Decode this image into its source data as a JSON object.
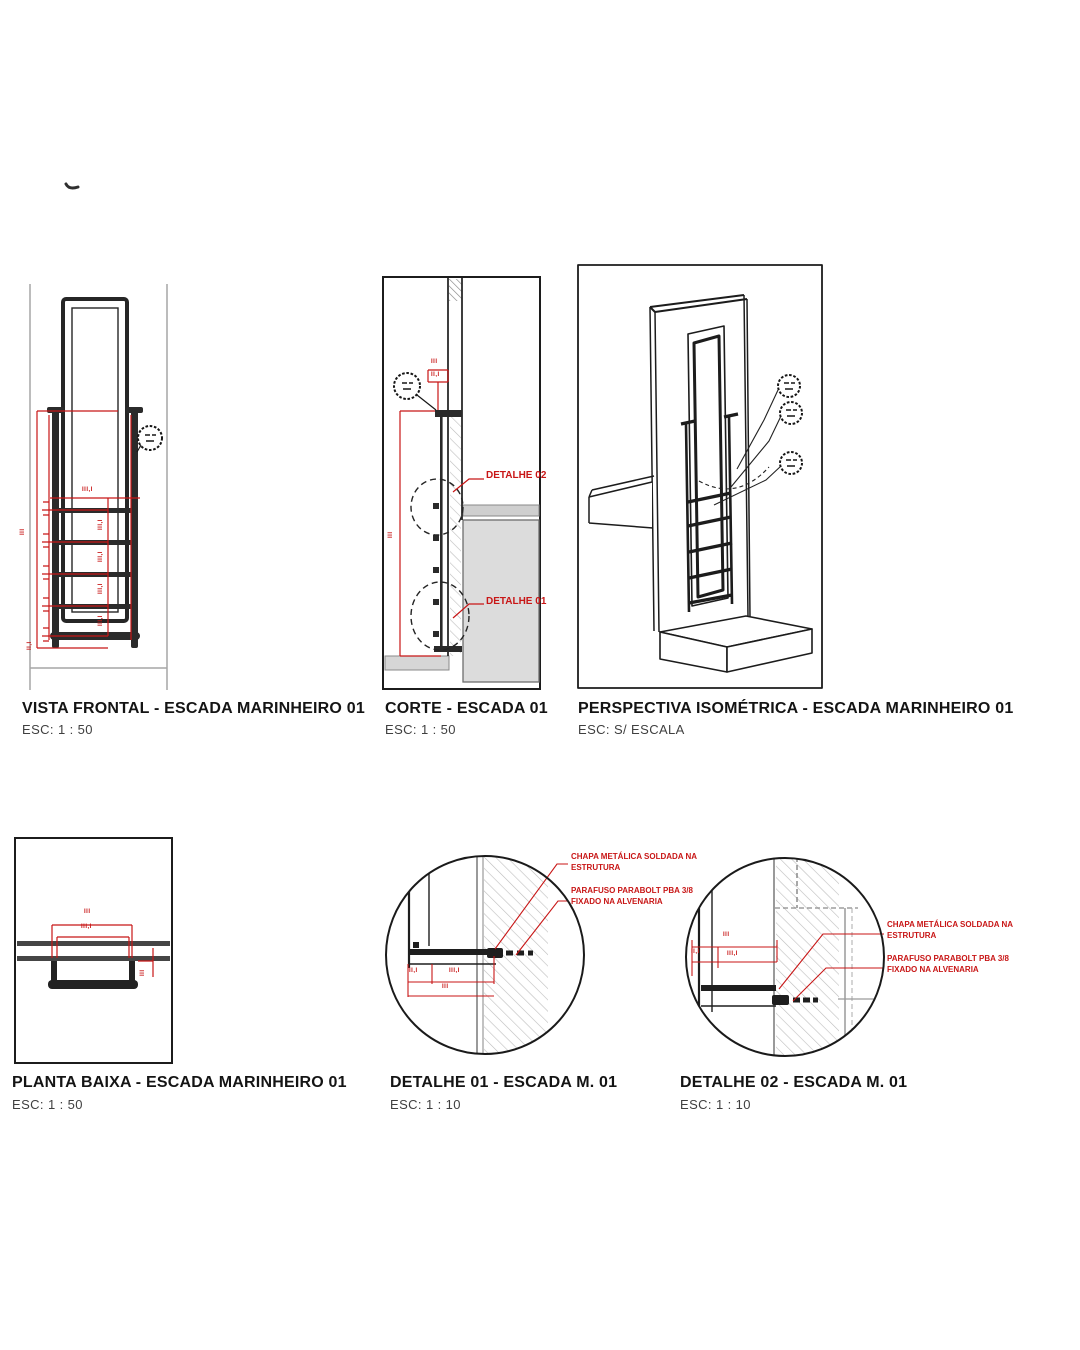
{
  "colors": {
    "annotation_red": "#c81616",
    "ink": "#1c1c1c",
    "wall_gray": "#9b9b9b",
    "slab_fill": "#dcdcdc"
  },
  "titles": {
    "vista_frontal": {
      "title": "VISTA FRONTAL - ESCADA MARINHEIRO 01",
      "scale": "ESC:  1 : 50"
    },
    "corte": {
      "title": "CORTE -  ESCADA 01",
      "scale": "ESC:  1 : 50"
    },
    "perspectiva": {
      "title": "PERSPECTIVA ISOMÉTRICA - ESCADA MARINHEIRO 01",
      "scale": "ESC: S/ ESCALA"
    },
    "planta_baixa": {
      "title": "PLANTA BAIXA - ESCADA MARINHEIRO 01",
      "scale": "ESC:  1 : 50"
    },
    "detalhe_01": {
      "title": "DETALHE 01 - ESCADA M. 01",
      "scale": "ESC:  1 : 10"
    },
    "detalhe_02": {
      "title": "DETALHE 02 - ESCADA M. 01",
      "scale": "ESC:  1 : 10"
    }
  },
  "vista_frontal": {
    "dim_height": "III",
    "dim_width": "III,I",
    "dim_spacing": "III,I",
    "dim_bottom": "II,I"
  },
  "corte": {
    "callout_top": "DETALHE 02",
    "callout_bottom": "DETALHE 01",
    "dim_top": "III",
    "dim_top_box": "II,I",
    "dim_height": "III"
  },
  "planta_baixa": {
    "dim_outer": "III",
    "dim_inner": "III,I",
    "dim_side": "III"
  },
  "detalhe_01": {
    "ann1_line1": "CHAPA METÁLICA SOLDADA NA",
    "ann1_line2": "ESTRUTURA",
    "ann2_line1": "PARAFUSO PARABOLT PBA 3/8",
    "ann2_line2": "FIXADO NA ALVENARIA",
    "dim_a": "II,I",
    "dim_b": "III,I",
    "dim_c": "III"
  },
  "detalhe_02": {
    "ann1_line1": "CHAPA METÁLICA SOLDADA NA",
    "ann1_line2": "ESTRUTURA",
    "ann2_line1": "PARAFUSO PARABOLT PBA 3/8",
    "ann2_line2": "FIXADO NA ALVENARIA",
    "dim_a": "III",
    "dim_b": "II,I",
    "dim_c": "III,I"
  }
}
